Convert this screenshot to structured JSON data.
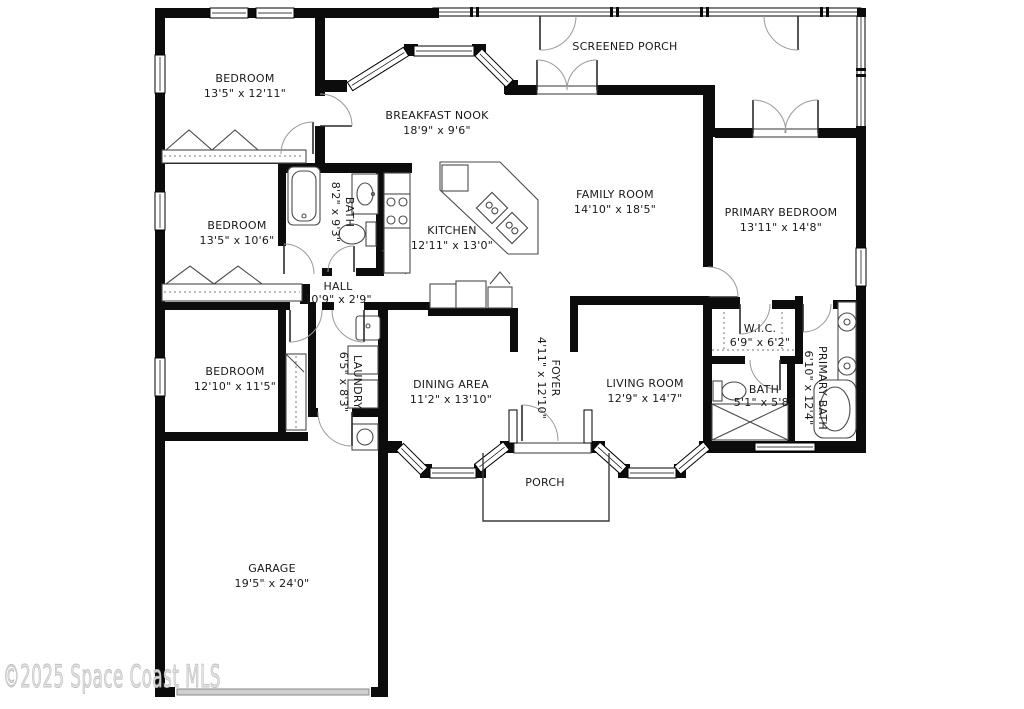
{
  "watermark": "©2025 Space Coast MLS",
  "plan_colors": {
    "walls": "#0c0c0c",
    "background": "#ffffff",
    "watermark": "#d9d9d9",
    "garage_door": "#cfcfcf"
  },
  "rooms": {
    "screened_porch": {
      "name": "SCREENED PORCH",
      "dims": ""
    },
    "bedroom_top": {
      "name": "BEDROOM",
      "dims": "13'5\" x 12'11\""
    },
    "breakfast_nook": {
      "name": "BREAKFAST NOOK",
      "dims": "18'9\" x 9'6\""
    },
    "family_room": {
      "name": "FAMILY ROOM",
      "dims": "14'10\" x 18'5\""
    },
    "primary_bedroom": {
      "name": "PRIMARY BEDROOM",
      "dims": "13'11\" x 14'8\""
    },
    "bedroom_middle": {
      "name": "BEDROOM",
      "dims": "13'5\" x 10'6\""
    },
    "bath_hall": {
      "name": "BATH",
      "dims": "8'2\" x 9'3\""
    },
    "kitchen": {
      "name": "KITCHEN",
      "dims": "12'11\" x 13'0\""
    },
    "hall": {
      "name": "HALL",
      "dims": "10'9\" x 2'9\""
    },
    "wic": {
      "name": "W.I.C.",
      "dims": "6'9\" x 6'2\""
    },
    "bedroom_lower": {
      "name": "BEDROOM",
      "dims": "12'10\" x 11'5\""
    },
    "laundry": {
      "name": "LAUNDRY",
      "dims": "6'5\" x 8'3\""
    },
    "dining_area": {
      "name": "DINING AREA",
      "dims": "11'2\" x 13'10\""
    },
    "foyer": {
      "name": "FOYER",
      "dims": "4'11\" x 12'10\""
    },
    "living_room": {
      "name": "LIVING ROOM",
      "dims": "12'9\" x 14'7\""
    },
    "bath_small": {
      "name": "BATH",
      "dims": "5'1\" x 5'8\""
    },
    "primary_bath": {
      "name": "PRIMARY BATH",
      "dims": "6'10\" x 12'4\""
    },
    "porch": {
      "name": "PORCH",
      "dims": ""
    },
    "garage": {
      "name": "GARAGE",
      "dims": "19'5\" x 24'0\""
    }
  }
}
